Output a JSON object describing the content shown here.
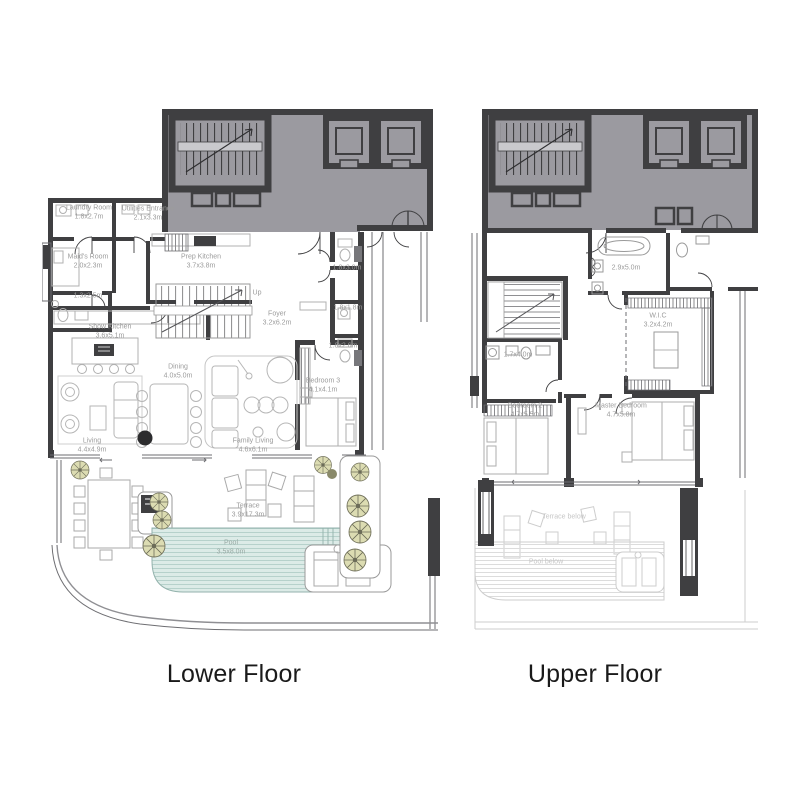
{
  "lower": {
    "title": "Lower Floor",
    "rooms": {
      "laundry": {
        "name": "Laundry Room",
        "dims": "1.8x2.7m"
      },
      "utilities": {
        "name": "Utilities Entrance",
        "dims": "2.1x3.3m"
      },
      "maids": {
        "name": "Maid's Room",
        "dims": "2.0x2.3m"
      },
      "maids_bath": {
        "dims": "1.3x2.5m"
      },
      "prep_kitchen": {
        "name": "Prep Kitchen",
        "dims": "3.7x3.8m"
      },
      "show_kitchen": {
        "name": "Show Kitchen",
        "dims": "3.6x5.1m"
      },
      "up": {
        "label": "Up"
      },
      "foyer": {
        "name": "Foyer",
        "dims": "3.2x6.2m"
      },
      "bath_top": {
        "dims": "1.8x3.0m"
      },
      "store_mid": {
        "dims": "1.8x1.8m"
      },
      "bath_bottom": {
        "dims": "1.8x2.6m"
      },
      "dining": {
        "name": "Dining",
        "dims": "4.0x5.0m"
      },
      "bedroom3": {
        "name": "Bedroom 3",
        "dims": "4.1x4.1m"
      },
      "family_living": {
        "name": "Family Living",
        "dims": "4.6x6.1m"
      },
      "living": {
        "name": "Living",
        "dims": "4.4x4.9m"
      },
      "terrace": {
        "name": "Terrace",
        "dims": "3.9x17.3m"
      },
      "pool": {
        "name": "Pool",
        "dims": "3.5x8.0m"
      }
    }
  },
  "upper": {
    "title": "Upper Floor",
    "rooms": {
      "master_bath": {
        "dims": "2.9x5.0m"
      },
      "wic": {
        "name": "W.I.C",
        "dims": "3.2x4.2m"
      },
      "bath": {
        "dims": "1.7x4.0m"
      },
      "bedroom2": {
        "name": "Bedroom 2",
        "dims": "4.7x5.5m"
      },
      "master_bedroom": {
        "name": "Master Bedroom",
        "dims": "4.7x5.8m"
      },
      "terrace_below": {
        "name": "Terrace below"
      },
      "pool_below": {
        "name": "Pool below"
      }
    }
  },
  "colors": {
    "wall": "#3f3f41",
    "common_area": "#9b9aa0",
    "pool_fill": "#dcebe7",
    "pool_stripe": "#b6d1cb",
    "tree": "#dcdcb2",
    "label_text": "#9c9c9c",
    "ghost": "#cdcdcd",
    "title_text": "#1a1a1a"
  }
}
